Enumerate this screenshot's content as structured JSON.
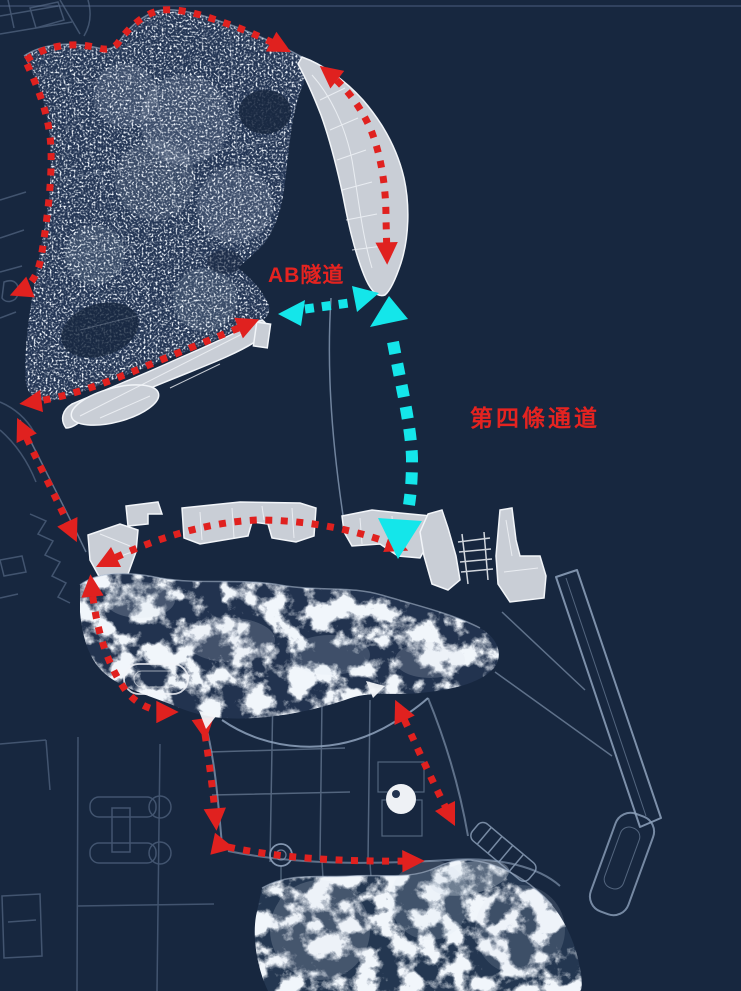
{
  "map": {
    "labels": {
      "ab_tunnel": "AB隧道",
      "fourth_corridor": "第四條通道"
    },
    "colors": {
      "background": "#17273F",
      "reclaimed_land": "#C9CED6",
      "route_red": "#E0211F",
      "corridor_cyan": "#14E6EA",
      "faint_line": "#5F7390",
      "label_red": "#E52320",
      "white": "#F2F5F9",
      "land_outline": "#B6C4D8"
    }
  }
}
